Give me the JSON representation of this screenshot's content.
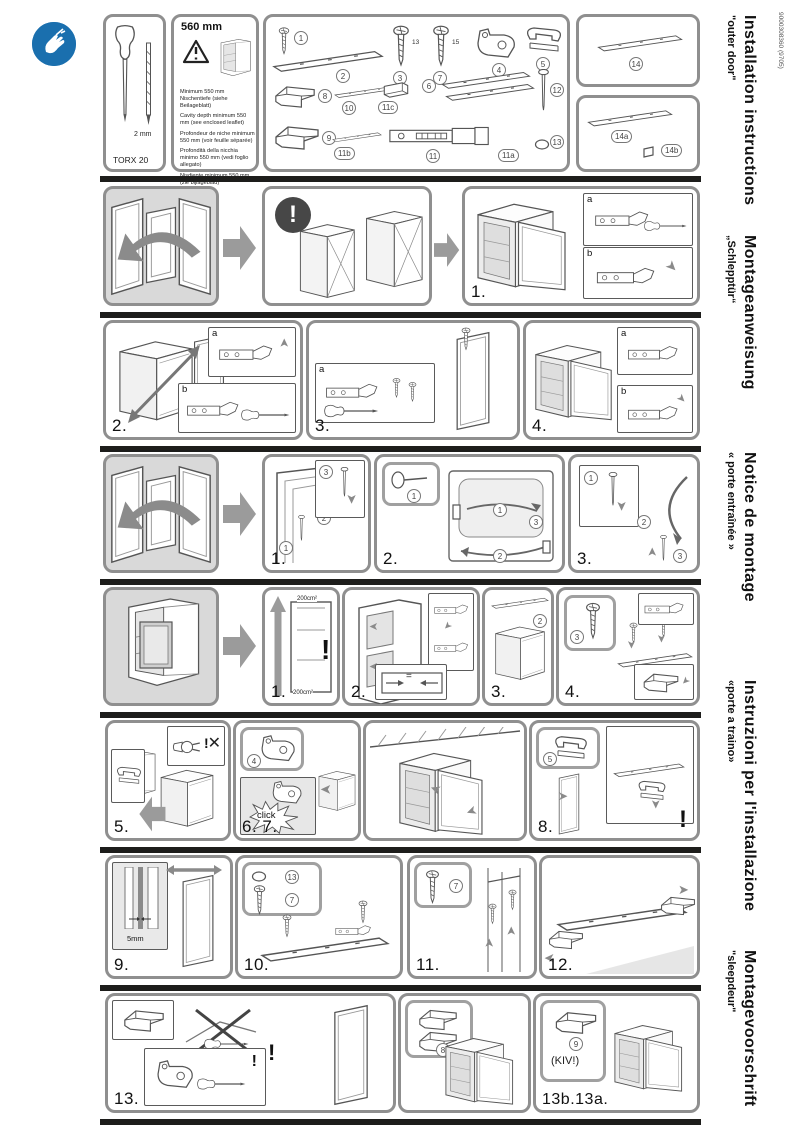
{
  "doc_code": "9000308360 (9705)",
  "languages": [
    {
      "title": "Installation instructions",
      "subtitle": "\"outer door\""
    },
    {
      "title": "Montageanweisung",
      "subtitle": "„Schlepptür“"
    },
    {
      "title": "Notice de montage",
      "subtitle": "« porte entraînée »"
    },
    {
      "title": "Instruzioni per l'installazione",
      "subtitle": "«porte a traino»"
    },
    {
      "title": "Montagevoorschrift",
      "subtitle": "\"sleepdeur\""
    }
  ],
  "tools": {
    "screwdriver_label": "TORX 20",
    "bit_label": "2 mm"
  },
  "niche": {
    "width_label": "560 mm",
    "notes": [
      "Minimum 550 mm Nischentiefe (siehe Beilageblatt)",
      "Cavity depth minimum 550 mm (see enclosed leaflet)",
      "Profondeur de niche minimum 550 mm (voir feuille séparée)",
      "Profondità della nicchia minimo 550 mm (vedi foglio allegato)",
      "Nisdiepte minimum 550 mm (zie bijlageblad)"
    ]
  },
  "parts": {
    "p1": "1",
    "p2": "2",
    "p3": "3",
    "p7": "7",
    "p4": "4",
    "p5": "5",
    "p8": "8",
    "p10": "10",
    "p11c": "11c",
    "p6": "6",
    "p12": "12",
    "p9": "9",
    "p11b": "11b",
    "p11": "11",
    "p11a": "11a",
    "p13": "13",
    "p14": "14",
    "p14a": "14a",
    "p14b": "14b",
    "screw3_len": "13",
    "screw7_len": "15"
  },
  "steps": {
    "row1": "1.",
    "row2_a": "2.",
    "row2_b": "3.",
    "row2_c": "4.",
    "row3_a": "1.",
    "row3_b": "2.",
    "row3_c": "3.",
    "row4_a": "1.",
    "row4_b": "2.",
    "row4_c": "3.",
    "row4_d": "4.",
    "row5_a": "5.",
    "row5_b": "6. 7.",
    "row5_c": "8.",
    "row6_a": "9.",
    "row6_b": "10.",
    "row6_c": "11.",
    "row6_d": "12.",
    "row7_a": "13.",
    "row7_b": "13b.13a."
  },
  "inset_labels": {
    "a": "a",
    "b": "b"
  },
  "callouts": {
    "c1": "1",
    "c2": "2",
    "c3": "3",
    "c4": "4",
    "c5": "5",
    "c7": "7",
    "c8": "8",
    "c9": "9",
    "c13": "13"
  },
  "annotations": {
    "click": "click",
    "kiv": "(KIV!)",
    "vent_area": "200cm²",
    "gap": "5mm",
    "warning": "!",
    "cross": "✕",
    "equal": "="
  },
  "colors": {
    "accent_blue": "#1a6fae",
    "separator_bar": "#1d1d1b",
    "panel_border": "#8f8f8f",
    "warning_circle": "#474747"
  }
}
